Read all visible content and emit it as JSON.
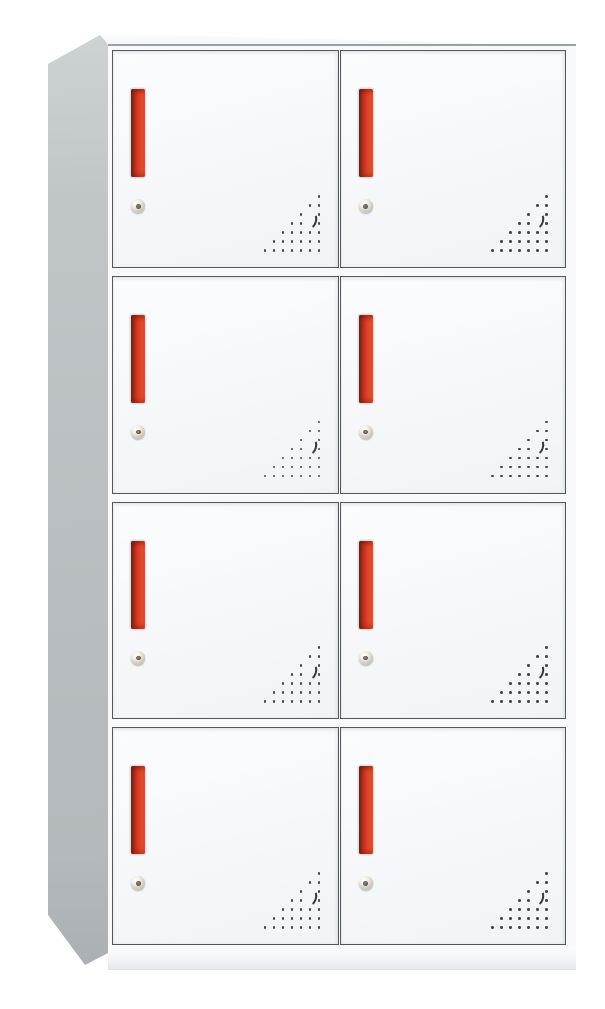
{
  "meta": {
    "description": "Product photo of a white steel office locker cabinet, 8 compartments, viewed from front-left",
    "view": "front-left-perspective"
  },
  "cabinet": {
    "rows": 4,
    "columns": 2,
    "door_count": 8,
    "door": {
      "handle": "red-recessed-vertical-pull",
      "lock": "round-cam-keyhole-lock",
      "vent": "triangular-perforation-pattern",
      "vent_rows": 7,
      "vent_crescent_cells": [
        [
          2,
          5
        ],
        [
          3,
          5
        ]
      ]
    },
    "colors": {
      "background": "#ffffff",
      "body_white": "#f7f9fa",
      "door_face": "#f5f7f9",
      "door_border": "#53585c",
      "side_panel_gray": "#b8bec1",
      "handle_red": "#e8492a",
      "handle_dark_red": "#8c2215",
      "lock_ring_beige": "#d6d0c2",
      "vent_dot_gray": "#42474b"
    }
  }
}
